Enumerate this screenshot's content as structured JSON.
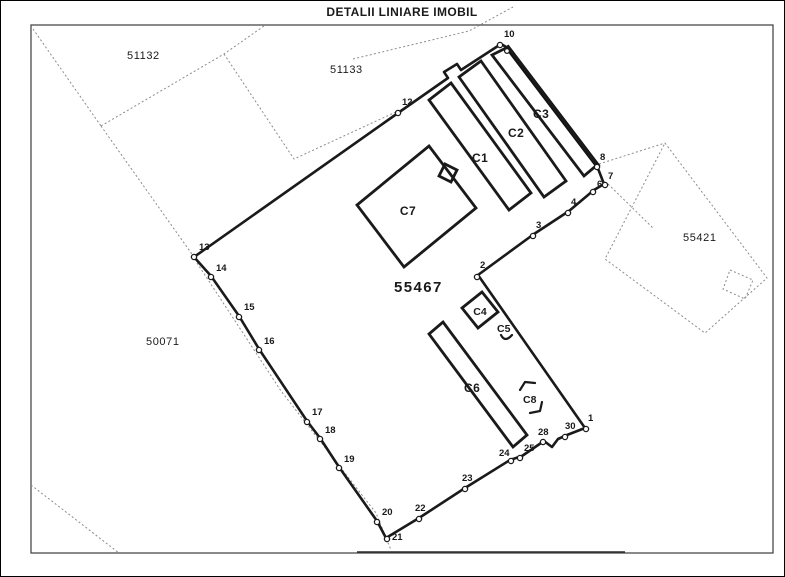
{
  "title": "DETALII LINIARE IMOBIL",
  "parcels": {
    "main": "55467",
    "northwest": "51132",
    "north": "51133",
    "east": "55421",
    "southwest": "50071"
  },
  "constructions": {
    "c1": "C1",
    "c2": "C2",
    "c3": "C3",
    "c4": "C4",
    "c5": "C5",
    "c6": "C6",
    "c7": "C7",
    "c8": "C8"
  },
  "boundary_points": {
    "p1": "1",
    "p2": "2",
    "p3": "3",
    "p4": "4",
    "p6": "6",
    "p7": "7",
    "p8": "8",
    "p10": "10",
    "p12": "12",
    "p13": "13",
    "p14": "14",
    "p15": "15",
    "p16": "16",
    "p17": "17",
    "p18": "18",
    "p19": "19",
    "p20": "20",
    "p21": "21",
    "p22": "22",
    "p23": "23",
    "p24": "24",
    "p25": "25",
    "p28": "28",
    "p30": "30"
  },
  "colors": {
    "boundary": "#1a1a1a",
    "neighbor_lines": "#8c8c8c",
    "paper": "#ffffff"
  }
}
